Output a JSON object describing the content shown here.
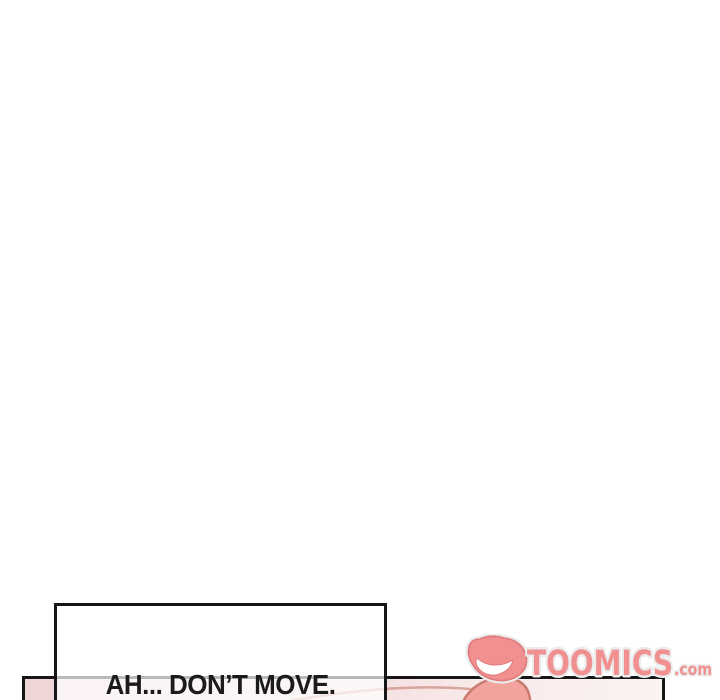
{
  "canvas": {
    "background": "#ffffff",
    "ink_color": "#161616"
  },
  "panel": {
    "fill_start": "#efd6d6",
    "fill_mid": "#f3dede",
    "fill_light": "#f9ecec",
    "fill_end": "#fbf2f2",
    "artwork": {
      "arc_color": "#d9a49b",
      "blob_fill": "#f2a39d",
      "blob_outline": "#c97b70"
    }
  },
  "speech_box": {
    "text": "AH... DON’T MOVE."
  },
  "watermark": {
    "icon": "toomics-grin-icon",
    "brand": "TOOMICS",
    "tld": ".com",
    "fill_color": "#f19090",
    "outline_color": "#ebebeb",
    "icon_edge_color": "#e07a7a"
  }
}
